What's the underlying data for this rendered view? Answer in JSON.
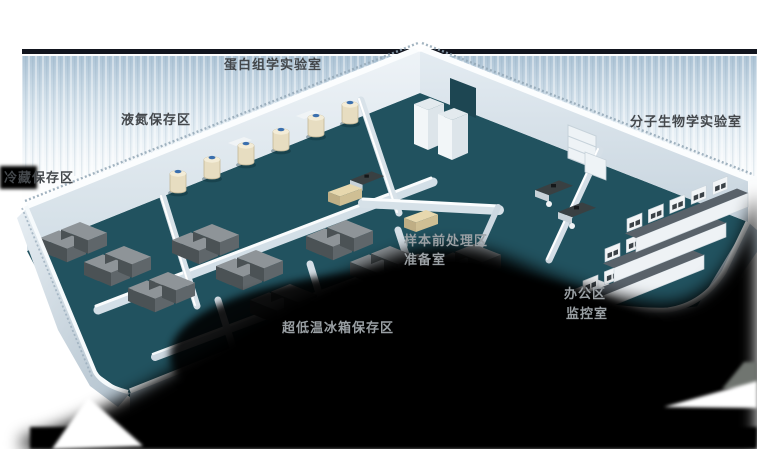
{
  "scene": {
    "type": "isometric-lab-floorplan",
    "background_color": "#ffffff",
    "backdrop_line_color": "#12151e",
    "wash_color": "#aec4d4",
    "shadow_color": "#000000",
    "floor_color": "#21525f",
    "wall_top_color": "#fafdfe",
    "wall_face_color": "#d9e4ec",
    "exterior_wall_color": "#b7c6d1",
    "freezer_color": "#5f666a",
    "tank_body_color": "#e7ddc1",
    "tank_cap_color": "#3a6fae",
    "bench_counter_color": "#59626a",
    "bench_body_color": "#eef2f5",
    "desk_color": "#394042"
  },
  "labels": [
    {
      "id": "proteomics-lab",
      "text": "蛋白组学实验室"
    },
    {
      "id": "liquid-nitrogen-storage",
      "text": "液氮保存区"
    },
    {
      "id": "cold-storage",
      "text": "冷藏保存区"
    },
    {
      "id": "molecular-biology-lab",
      "text": "分子生物学实验室"
    },
    {
      "id": "sample-pretreatment-area",
      "text": "样本前处理区"
    },
    {
      "id": "prep-room",
      "text": "准备室"
    },
    {
      "id": "office-area",
      "text": "办公区"
    },
    {
      "id": "monitoring-room",
      "text": "监控室"
    },
    {
      "id": "ult-freezer-storage",
      "text": "超低温冰箱保存区"
    }
  ]
}
